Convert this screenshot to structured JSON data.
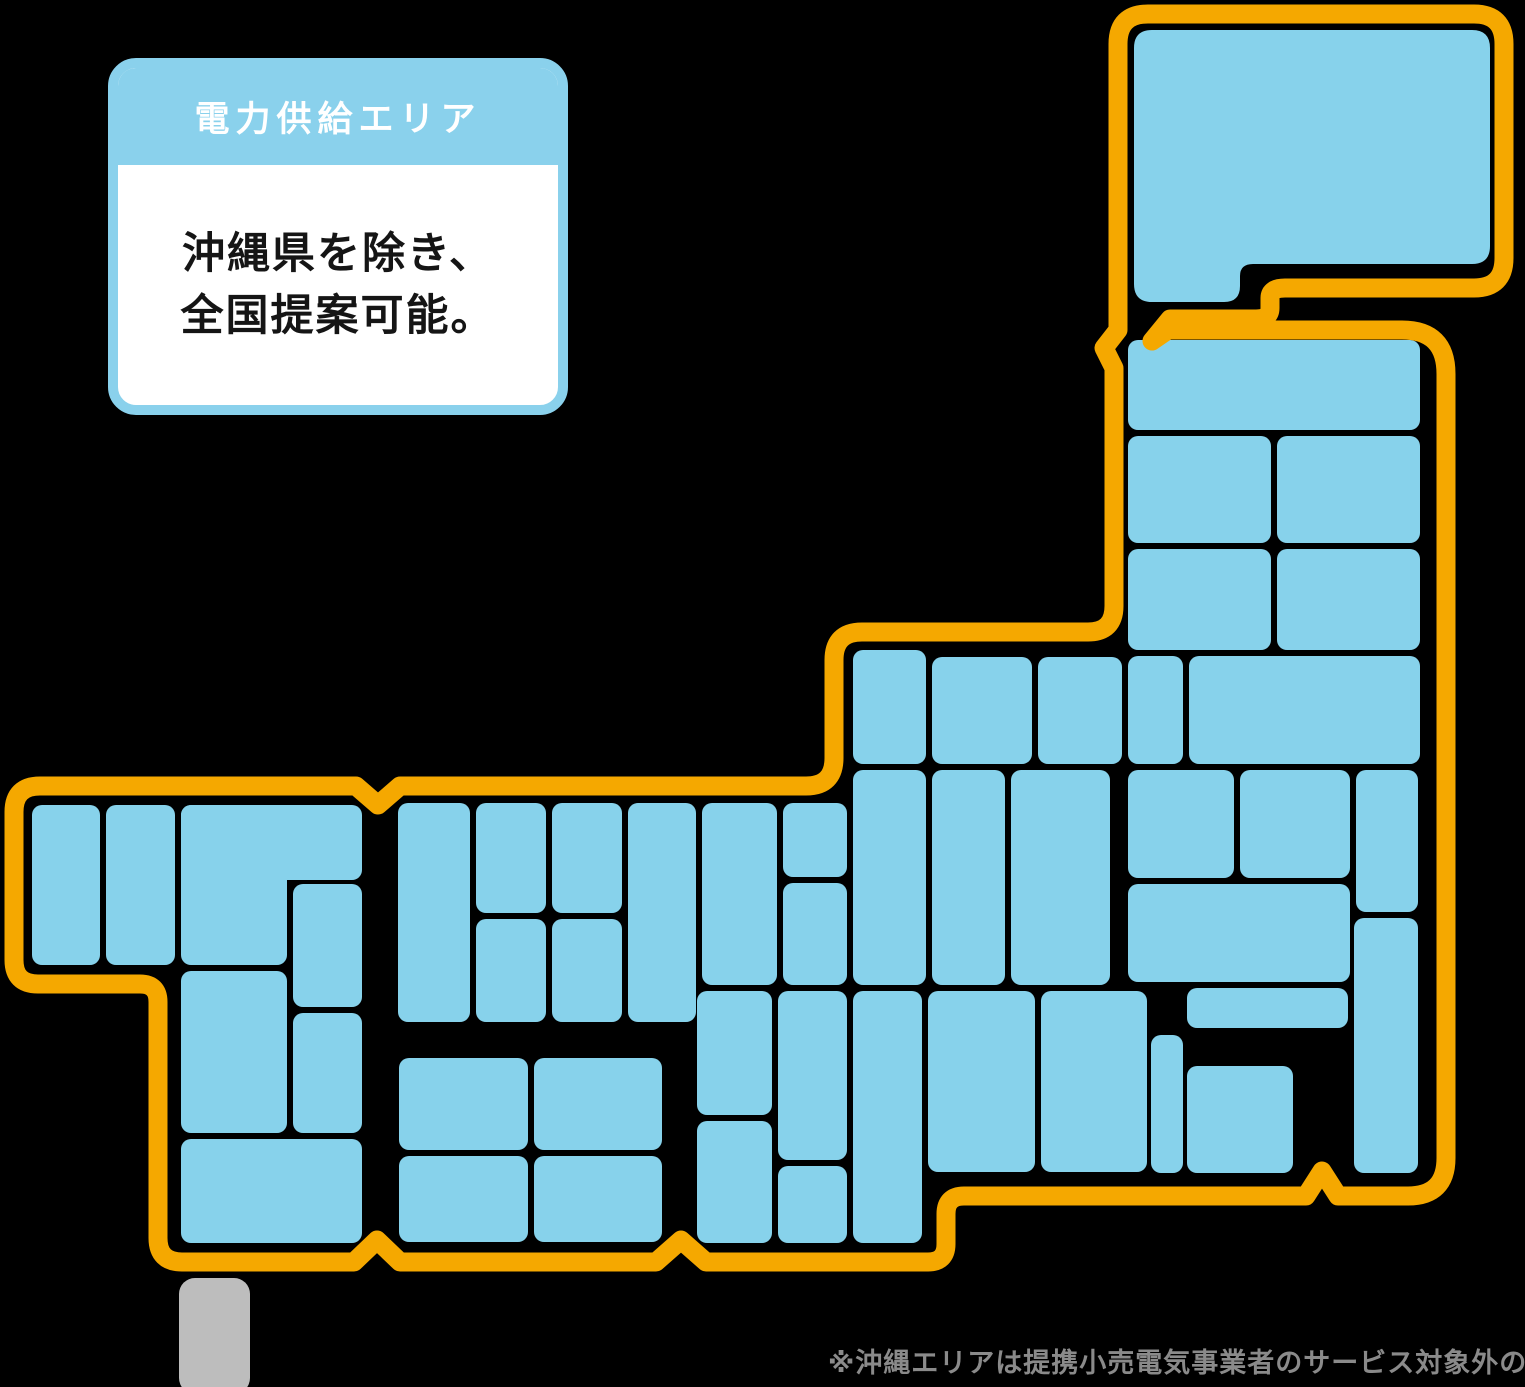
{
  "page": {
    "background_color": "#000000"
  },
  "card": {
    "title": "電力供給エリア",
    "body_lines": [
      "沖縄県を除き、",
      "全国提案可能。"
    ],
    "header_bg": "#8AD1EC",
    "border_color": "#8AD1EC",
    "body_bg": "#FFFFFF",
    "title_color": "#FFFFFF",
    "body_text_color": "#151515"
  },
  "footnote": {
    "text": "※沖縄エリアは提携小売電気事業者のサービス対象外のため",
    "color": "#8A8A8A"
  },
  "map": {
    "outline_color": "#F5A800",
    "cell_color": "#87D2EB",
    "okinawa_color": "#BDBDBD",
    "outline_stroke_width": 19,
    "outline_path": "M 1148 14 H 1474 Q 1504 14 1504 44 V 258 Q 1504 288 1474 288 H 1285 Q 1270 288 1270 298 V 308 Q 1270 319 1256 319 H 1170 L 1152 341 L 1168 330 H 1402 Q 1446 330 1446 374 V 1158 Q 1446 1196 1408 1196 H 1338 L 1322 1171 L 1306 1196 H 964 Q 946 1196 946 1214 V 1244 Q 946 1262 928 1262 H 706 L 681 1240 L 656 1262 H 400 L 377 1240 L 354 1262 H 182 Q 158 1262 158 1238 V 1002 Q 158 984 140 984 H 38 Q 14 984 14 960 V 812 Q 14 786 40 786 H 356 L 378 805 L 400 786 H 806 Q 834 786 834 758 V 660 Q 834 632 862 632 H 1088 Q 1114 632 1114 606 V 368 L 1104 348 L 1118 330 V 44 Q 1118 14 1148 14 Z",
    "hokkaido_path": "M 1152 30 H 1472 Q 1490 30 1490 48 V 246 Q 1490 264 1472 264 H 1253 Q 1240 264 1240 276 V 286 Q 1240 302 1224 302 H 1152 Q 1134 302 1134 284 V 48 Q 1134 30 1152 30 Z",
    "okinawa": {
      "x": 179,
      "y": 1278,
      "w": 71,
      "h": 116,
      "r": 16
    },
    "cell_radius": 10,
    "cells": {
      "tohoku": [
        {
          "x": 1128,
          "y": 340,
          "w": 292,
          "h": 90
        },
        {
          "x": 1128,
          "y": 436,
          "w": 143,
          "h": 107
        },
        {
          "x": 1277,
          "y": 436,
          "w": 143,
          "h": 107
        },
        {
          "x": 1128,
          "y": 549,
          "w": 143,
          "h": 101
        },
        {
          "x": 1277,
          "y": 549,
          "w": 143,
          "h": 101
        },
        {
          "x": 1128,
          "y": 656,
          "w": 55,
          "h": 108
        },
        {
          "x": 1189,
          "y": 656,
          "w": 231,
          "h": 108
        }
      ],
      "kanto-chubu": [
        {
          "x": 853,
          "y": 650,
          "w": 73,
          "h": 114
        },
        {
          "x": 932,
          "y": 657,
          "w": 100,
          "h": 107
        },
        {
          "x": 1038,
          "y": 657,
          "w": 84,
          "h": 107
        },
        {
          "x": 853,
          "y": 770,
          "w": 73,
          "h": 215
        },
        {
          "x": 932,
          "y": 770,
          "w": 73,
          "h": 215
        },
        {
          "x": 1011,
          "y": 770,
          "w": 99,
          "h": 215
        },
        {
          "x": 1128,
          "y": 770,
          "w": 106,
          "h": 108
        },
        {
          "x": 1240,
          "y": 770,
          "w": 110,
          "h": 108
        },
        {
          "x": 1356,
          "y": 770,
          "w": 62,
          "h": 142
        },
        {
          "x": 1128,
          "y": 884,
          "w": 222,
          "h": 98
        },
        {
          "x": 1354,
          "y": 918,
          "w": 64,
          "h": 255
        },
        {
          "x": 1187,
          "y": 988,
          "w": 161,
          "h": 40
        },
        {
          "x": 1151,
          "y": 1035,
          "w": 32,
          "h": 138
        },
        {
          "x": 1187,
          "y": 1066,
          "w": 106,
          "h": 107
        }
      ],
      "kansai": [
        {
          "x": 697,
          "y": 991,
          "w": 75,
          "h": 124
        },
        {
          "x": 778,
          "y": 991,
          "w": 69,
          "h": 169
        },
        {
          "x": 697,
          "y": 1121,
          "w": 75,
          "h": 122
        },
        {
          "x": 778,
          "y": 1166,
          "w": 69,
          "h": 77
        },
        {
          "x": 853,
          "y": 991,
          "w": 69,
          "h": 252
        },
        {
          "x": 928,
          "y": 991,
          "w": 107,
          "h": 181
        },
        {
          "x": 1041,
          "y": 991,
          "w": 106,
          "h": 181
        }
      ],
      "chugoku": [
        {
          "x": 398,
          "y": 803,
          "w": 72,
          "h": 219
        },
        {
          "x": 476,
          "y": 803,
          "w": 70,
          "h": 110
        },
        {
          "x": 476,
          "y": 919,
          "w": 70,
          "h": 103
        },
        {
          "x": 552,
          "y": 803,
          "w": 70,
          "h": 110
        },
        {
          "x": 552,
          "y": 919,
          "w": 70,
          "h": 103
        },
        {
          "x": 628,
          "y": 803,
          "w": 68,
          "h": 219
        },
        {
          "x": 702,
          "y": 803,
          "w": 75,
          "h": 182
        },
        {
          "x": 783,
          "y": 803,
          "w": 64,
          "h": 74
        },
        {
          "x": 783,
          "y": 883,
          "w": 64,
          "h": 102
        }
      ],
      "shikoku": [
        {
          "x": 399,
          "y": 1058,
          "w": 129,
          "h": 92
        },
        {
          "x": 534,
          "y": 1058,
          "w": 128,
          "h": 92
        },
        {
          "x": 399,
          "y": 1156,
          "w": 129,
          "h": 86
        },
        {
          "x": 534,
          "y": 1156,
          "w": 128,
          "h": 86
        }
      ],
      "kyushu": [
        {
          "x": 32,
          "y": 805,
          "w": 68,
          "h": 160
        },
        {
          "x": 106,
          "y": 805,
          "w": 69,
          "h": 160
        },
        {
          "x": 181,
          "y": 805,
          "w": 181,
          "h": 75
        },
        {
          "x": 181,
          "y": 805,
          "w": 106,
          "h": 160
        },
        {
          "x": 293,
          "y": 884,
          "w": 69,
          "h": 123
        },
        {
          "x": 181,
          "y": 971,
          "w": 106,
          "h": 162
        },
        {
          "x": 293,
          "y": 1013,
          "w": 69,
          "h": 120
        },
        {
          "x": 181,
          "y": 1139,
          "w": 181,
          "h": 104
        }
      ]
    }
  }
}
